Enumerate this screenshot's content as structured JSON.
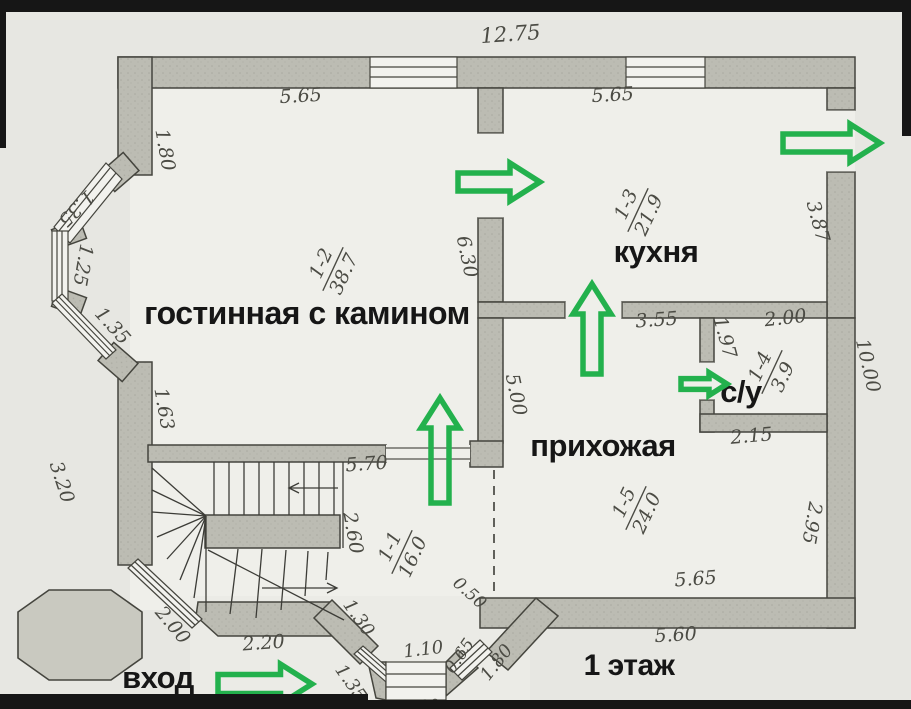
{
  "page": {
    "floor_label": "1 этаж",
    "entrance_label": "вход",
    "overall_width": "12.75"
  },
  "colors": {
    "paper": "#e7e7e2",
    "room": "#efefea",
    "wall_fill": "#bcbcb3",
    "wall_stroke": "#45453e",
    "ink": "#4b4b44",
    "label_ink": "#161616",
    "green": "#23b14d",
    "frame": "#161616"
  },
  "rooms": [
    {
      "number": "1-1",
      "area": "16.0",
      "label": ""
    },
    {
      "number": "1-2",
      "area": "38.7",
      "label": "гостинная с камином"
    },
    {
      "number": "1-3",
      "area": "21.9",
      "label": "кухня"
    },
    {
      "number": "1-4",
      "area": "3.9",
      "label": "с/у"
    },
    {
      "number": "1-5",
      "area": "24.0",
      "label": "прихожая"
    }
  ],
  "room_labels": [
    {
      "name": "room-label-living",
      "text": "гостинная с камином",
      "x": 307,
      "y": 324,
      "size": 32
    },
    {
      "name": "room-label-kitchen",
      "text": "кухня",
      "x": 656,
      "y": 262,
      "size": 31
    },
    {
      "name": "room-label-hall",
      "text": "прихожая",
      "x": 603,
      "y": 456,
      "size": 31
    },
    {
      "name": "room-label-bathroom",
      "text": "с/у",
      "x": 741,
      "y": 402,
      "size": 31
    },
    {
      "name": "entrance-label",
      "text": "вход",
      "x": 158,
      "y": 688,
      "size": 31
    },
    {
      "name": "floor-label",
      "text": "1 этаж",
      "x": 629,
      "y": 675,
      "size": 30
    }
  ],
  "area_marks": [
    {
      "name": "area-mark-1-2",
      "number": "1-2",
      "area": "38.7",
      "x": 333,
      "y": 269,
      "rot": -65
    },
    {
      "name": "area-mark-1-3",
      "number": "1-3",
      "area": "21.9",
      "x": 638,
      "y": 210,
      "rot": -65
    },
    {
      "name": "area-mark-1-4",
      "number": "1-4",
      "area": "3.9",
      "x": 772,
      "y": 372,
      "rot": -65
    },
    {
      "name": "area-mark-1-1",
      "number": "1-1",
      "area": "16.0",
      "x": 402,
      "y": 552,
      "rot": -65
    },
    {
      "name": "area-mark-1-5",
      "number": "1-5",
      "area": "24.0",
      "x": 636,
      "y": 508,
      "rot": -65
    }
  ],
  "dimensions": [
    {
      "t": "12.75",
      "x": 511,
      "y": 41,
      "r": -4,
      "size": 21
    },
    {
      "t": "5.65",
      "x": 301,
      "y": 102,
      "r": -3
    },
    {
      "t": "5.65",
      "x": 613,
      "y": 101,
      "r": -3
    },
    {
      "t": "1.80",
      "x": 159,
      "y": 151,
      "r": 80
    },
    {
      "t": "1.35",
      "x": 72,
      "y": 204,
      "r": 135
    },
    {
      "t": "1.25",
      "x": 77,
      "y": 264,
      "r": 100
    },
    {
      "t": "1.35",
      "x": 108,
      "y": 330,
      "r": 48
    },
    {
      "t": "6.30",
      "x": 461,
      "y": 258,
      "r": 78
    },
    {
      "t": "3.87",
      "x": 812,
      "y": 223,
      "r": 75
    },
    {
      "t": "10.00",
      "x": 862,
      "y": 367,
      "r": 77
    },
    {
      "t": "3.55",
      "x": 657,
      "y": 326,
      "r": -4
    },
    {
      "t": "2.00",
      "x": 786,
      "y": 324,
      "r": -6
    },
    {
      "t": "1.97",
      "x": 719,
      "y": 339,
      "r": 75
    },
    {
      "t": "2.15",
      "x": 752,
      "y": 442,
      "r": -5
    },
    {
      "t": "1.63",
      "x": 158,
      "y": 410,
      "r": 80
    },
    {
      "t": "3.20",
      "x": 56,
      "y": 484,
      "r": 72
    },
    {
      "t": "5.00",
      "x": 510,
      "y": 396,
      "r": 78
    },
    {
      "t": "5.70",
      "x": 367,
      "y": 470,
      "r": -4
    },
    {
      "t": "2.60",
      "x": 347,
      "y": 534,
      "r": 80
    },
    {
      "t": "2.95",
      "x": 806,
      "y": 522,
      "r": 100
    },
    {
      "t": "5.65",
      "x": 696,
      "y": 585,
      "r": -4
    },
    {
      "t": "5.60",
      "x": 676,
      "y": 641,
      "r": -3
    },
    {
      "t": "0.50",
      "x": 466,
      "y": 597,
      "r": 42,
      "size": 17
    },
    {
      "t": "2.00",
      "x": 168,
      "y": 629,
      "r": 50
    },
    {
      "t": "2.20",
      "x": 264,
      "y": 649,
      "r": -4
    },
    {
      "t": "1.30",
      "x": 354,
      "y": 621,
      "r": 55,
      "size": 18
    },
    {
      "t": "1.35",
      "x": 346,
      "y": 686,
      "r": 55,
      "size": 18
    },
    {
      "t": "1.10",
      "x": 424,
      "y": 655,
      "r": -7,
      "size": 18
    },
    {
      "t": "0.65",
      "x": 464,
      "y": 659,
      "r": -55,
      "size": 17
    },
    {
      "t": "1.80",
      "x": 501,
      "y": 666,
      "r": -52,
      "size": 18
    },
    {
      "t": "1.60",
      "x": 420,
      "y": 713,
      "r": -3,
      "size": 18
    }
  ],
  "arrows": [
    {
      "name": "arrow-door-living-kitchen",
      "x": 458,
      "y": 182,
      "len": 82,
      "dir": 0,
      "s": 1
    },
    {
      "name": "arrow-exit-right",
      "x": 783,
      "y": 143,
      "len": 97,
      "dir": 0,
      "s": 1
    },
    {
      "name": "arrow-door-kitchen-hall",
      "x": 592,
      "y": 374,
      "len": 90,
      "dir": -90,
      "s": 1
    },
    {
      "name": "arrow-door-bathroom",
      "x": 681,
      "y": 384,
      "len": 46,
      "dir": 0,
      "s": 0.6
    },
    {
      "name": "arrow-opening-hall-living",
      "x": 440,
      "y": 503,
      "len": 105,
      "dir": -90,
      "s": 1
    },
    {
      "name": "arrow-entrance",
      "x": 218,
      "y": 684,
      "len": 94,
      "dir": 0,
      "s": 1.05
    }
  ]
}
